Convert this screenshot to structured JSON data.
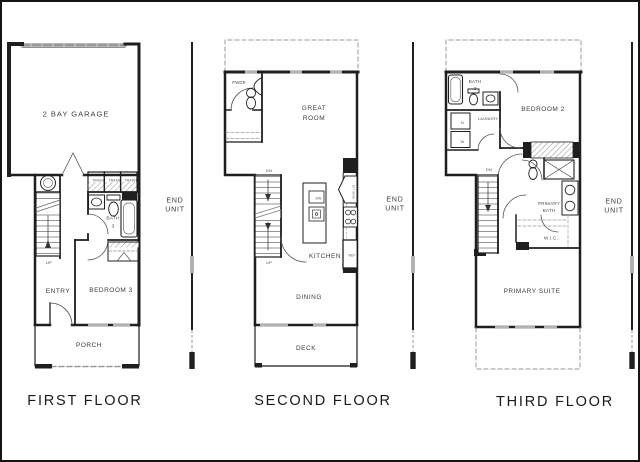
{
  "canvas": {
    "width": 640,
    "height": 462
  },
  "colors": {
    "background": "#ffffff",
    "wall": "#1f1f1f",
    "window_fill": "#b3b3b3",
    "dashed_line": "#999999",
    "label_text": "#3d3d3d"
  },
  "floors": [
    {
      "title": "FIRST FLOOR",
      "end_unit": [
        "END",
        "UNIT"
      ],
      "labels": {
        "garage": "2 BAY GARAGE",
        "trash": "TRASH",
        "bath": [
          "BATH",
          "3"
        ],
        "entry": "ENTRY",
        "bedroom": "BEDROOM 3",
        "porch": "PORCH",
        "up": "UP"
      }
    },
    {
      "title": "SECOND FLOOR",
      "end_unit": [
        "END",
        "UNIT"
      ],
      "labels": {
        "pwdr": "PWDR",
        "great_room": [
          "GREAT",
          "ROOM"
        ],
        "kitchen": "KITCHEN",
        "dining": "DINING",
        "deck": "DECK",
        "dn": "DN",
        "up": "UP",
        "dw": "DW",
        "ref": "REF",
        "kit_sink": "KIT SINK"
      }
    },
    {
      "title": "THIRD FLOOR",
      "end_unit": [
        "END",
        "UNIT"
      ],
      "labels": {
        "bath": [
          "BATH",
          "2"
        ],
        "laundry": "LAUNDRY",
        "dryer": "D",
        "washer": "W",
        "bedroom": "BEDROOM 2",
        "primary_bath": [
          "PRIMARY",
          "BATH"
        ],
        "wic": "W.I.C.",
        "primary_suite": "PRIMARY SUITE",
        "dn": "DN"
      }
    }
  ]
}
